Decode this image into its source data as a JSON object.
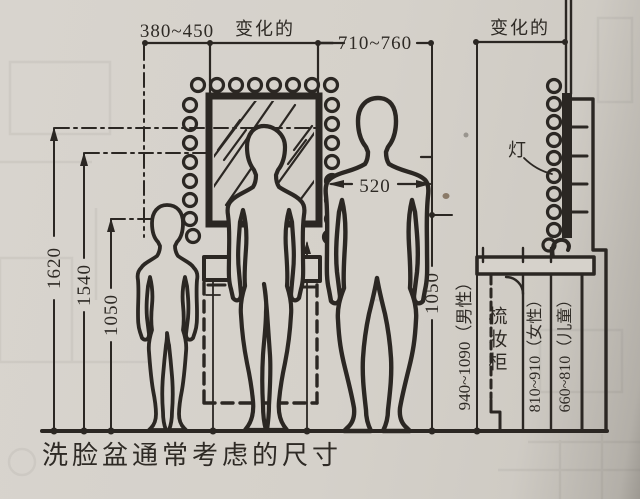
{
  "caption": "洗脸盆通常考虑的尺寸",
  "dims": {
    "span_380_450": "380~450",
    "variable_left": "变化的",
    "span_710_760": "710~760",
    "variable_right": "变化的",
    "left_heights": [
      "1620",
      "1540",
      "1050"
    ],
    "shoulder_width": "520",
    "right_height": "1050",
    "counter_male": "940~1090（男性）",
    "counter_female": "810~910（女性）",
    "counter_child": "660~810（儿童）"
  },
  "labels": {
    "lamp": "灯",
    "vanity_cabinet": "梳妆柜"
  },
  "colors": {
    "paper": "#d6d2cb",
    "ink": "#2b2723"
  }
}
